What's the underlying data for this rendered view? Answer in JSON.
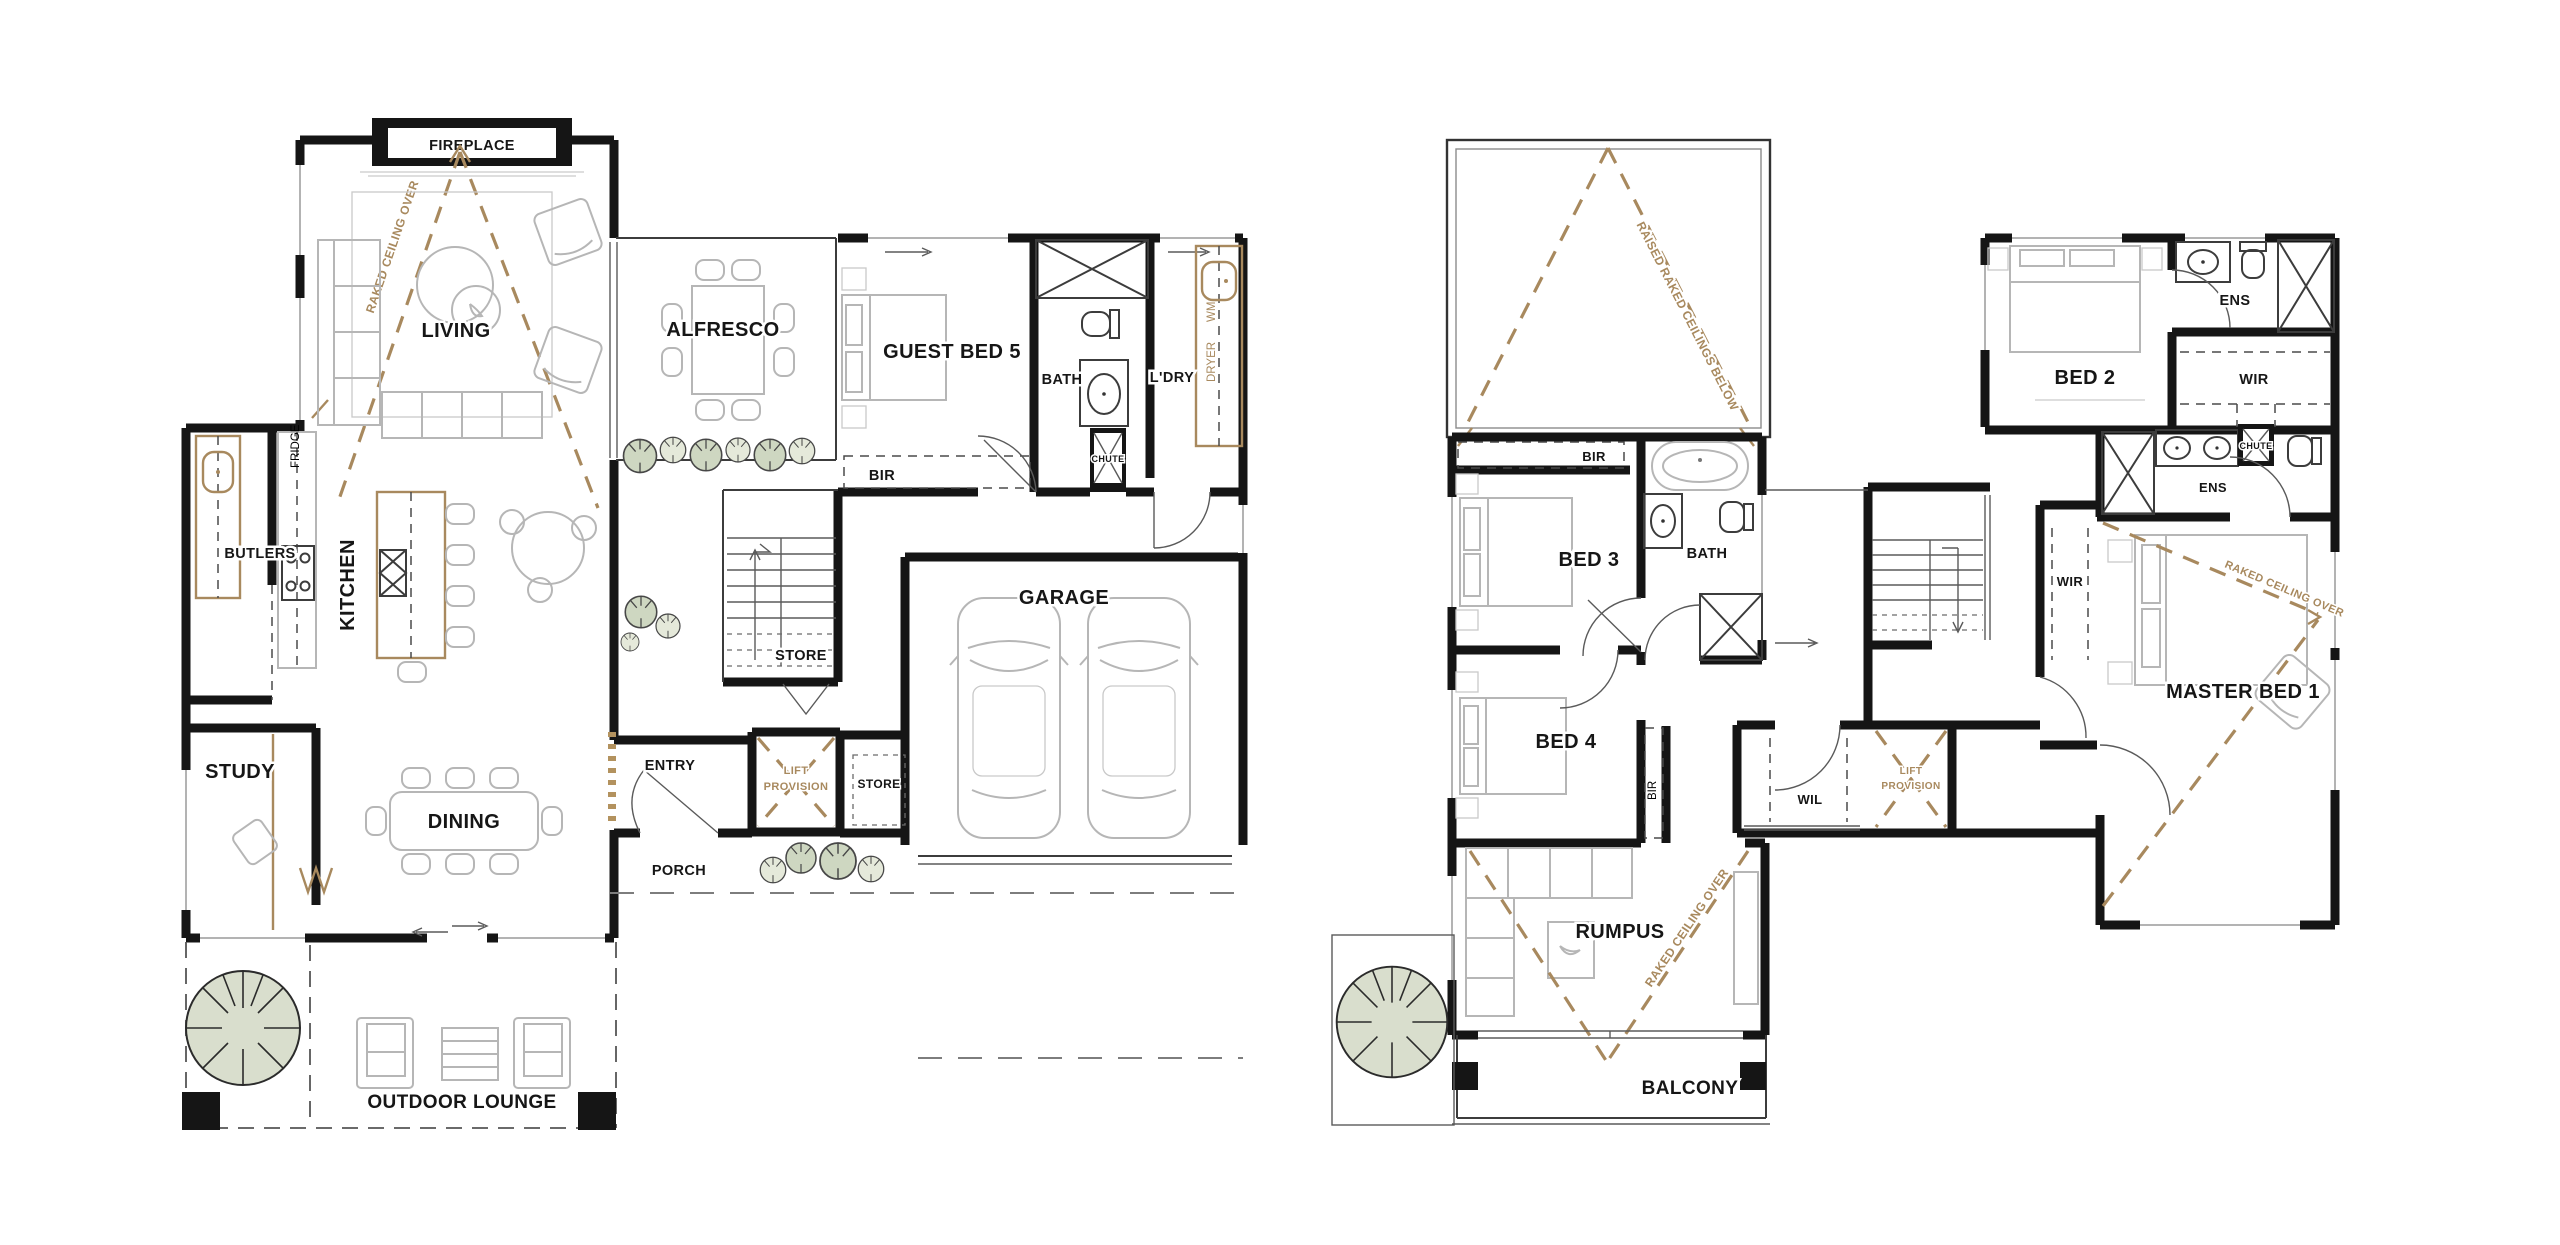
{
  "palette": {
    "wall": "#151515",
    "furniture_line": "#b6b6b6",
    "tan_accent": "#a8895e",
    "tree_fill": "#d9decd",
    "bush_fill_dark": "#ced7c1",
    "bush_fill_light": "#e5e9da",
    "background": "#ffffff",
    "label_color": "#161616"
  },
  "ground_floor": {
    "fireplace": "FIREPLACE",
    "raked_ceiling_note": "RAKED CEILING OVER",
    "living": "LIVING",
    "alfresco": "ALFRESCO",
    "guest_bed": "GUEST BED 5",
    "bath": "BATH",
    "chute": "CHUTE",
    "laundry": "L'DRY",
    "washing_machine": "WM",
    "dryer": "DRYER",
    "robe_bir": "BIR",
    "store_under_stairs": "STORE",
    "fridge": "FRIDGE",
    "butlers": "BUTLERS",
    "kitchen": "KITCHEN",
    "study": "STUDY",
    "dining": "DINING",
    "entry": "ENTRY",
    "lift_provision_line1": "LIFT",
    "lift_provision_line2": "PROVISION",
    "store_garage": "STORE",
    "porch": "PORCH",
    "garage": "GARAGE",
    "outdoor_lounge": "OUTDOOR LOUNGE"
  },
  "first_floor": {
    "raised_raked_note": "RAISED RAKED CEILINGS BELOW",
    "robe_bir_bed3": "BIR",
    "bed3": "BED 3",
    "bath": "BATH",
    "bed4": "BED 4",
    "robe_bir_bed4": "BIR",
    "rumpus": "RUMPUS",
    "raked_rumpus_note": "RAKED CEILING OVER",
    "balcony": "BALCONY",
    "wil": "WIL",
    "lift_provision_line1": "LIFT",
    "lift_provision_line2": "PROVISION",
    "bed2": "BED 2",
    "ens_bed2": "ENS",
    "wir_bed2": "WIR",
    "chute": "CHUTE",
    "ens_master": "ENS",
    "master_bed": "MASTER BED 1",
    "raked_master_note": "RAKED CEILING OVER",
    "wir_master": "WIR"
  }
}
